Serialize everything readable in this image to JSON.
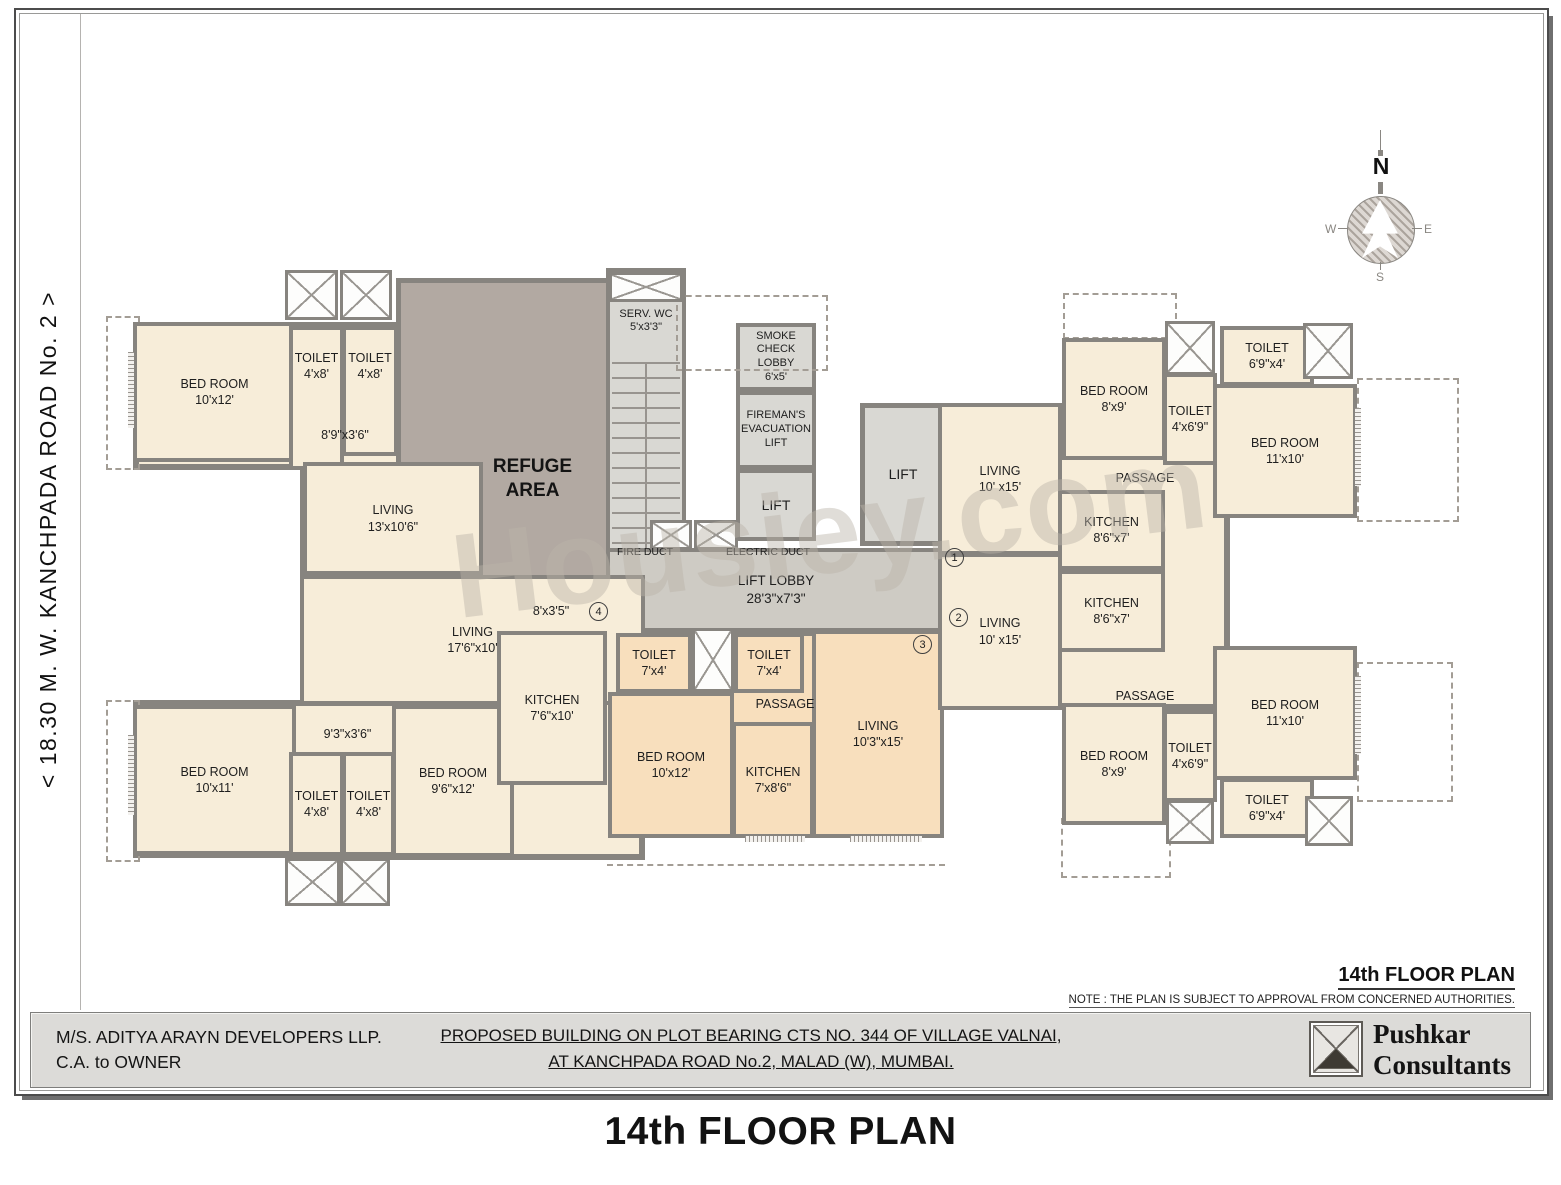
{
  "road_label": "<  18.30 M. W.  KANCHPADA ROAD No. 2  >",
  "watermark": "Housiey.com",
  "compass": {
    "n": "N",
    "e": "E",
    "s": "S",
    "w": "W"
  },
  "titles": {
    "plan_heading": "14th FLOOR PLAN",
    "note": "NOTE : THE PLAN IS SUBJECT TO APPROVAL FROM CONCERNED AUTHORITIES.",
    "main": "14th FLOOR PLAN"
  },
  "footer": {
    "developer_line1": "M/S. ADITYA ARAYN DEVELOPERS LLP.",
    "developer_line2": "C.A. to OWNER",
    "project_line1": "PROPOSED BUILDING ON PLOT BEARING CTS NO. 344 OF VILLAGE VALNAI,",
    "project_line2": "AT KANCHPADA ROAD No.2, MALAD (W), MUMBAI.",
    "consultant_line1": "Pushkar",
    "consultant_line2": "Consultants"
  },
  "labels": {
    "refuge_l1": "REFUGE",
    "refuge_l2": "AREA",
    "serv_l1": "SERV. WC",
    "serv_dims": "5'x3'3\"",
    "smoke_l1": "SMOKE",
    "smoke_l2": "CHECK",
    "smoke_l3": "LOBBY",
    "smoke_dims": "6'x5'",
    "fireman_l1": "FIREMAN'S",
    "fireman_l2": "EVACUATION",
    "fireman_l3": "LIFT",
    "lift": "LIFT",
    "lift_lobby": "LIFT LOBBY",
    "lift_lobby_dims": "28'3\"x7'3\"",
    "fire_duct": "FIRE DUCT",
    "electric_duct": "ELECTRIC DUCT",
    "passage": "PASSAGE",
    "passage_tl_dims": "8'9\"x3'6\"",
    "passage_bl_dims": "9'3\"x3'6\"",
    "passage_k_dims": "8'x3'5\""
  },
  "units": {
    "u1": "1",
    "u2": "2",
    "u3": "3",
    "u4": "4"
  },
  "rooms": {
    "bedroom_tl": {
      "name": "BED ROOM",
      "dims": "10'x12'"
    },
    "toilet_tl1": {
      "name": "TOILET",
      "dims": "4'x8'"
    },
    "toilet_tl2": {
      "name": "TOILET",
      "dims": "4'x8'"
    },
    "living_tl": {
      "name": "LIVING",
      "dims": "13'x10'6\""
    },
    "living_bl": {
      "name": "LIVING",
      "dims": "17'6\"x10'"
    },
    "bedroom_bl1": {
      "name": "BED ROOM",
      "dims": "10'x11'"
    },
    "toilet_bl1": {
      "name": "TOILET",
      "dims": "4'x8'"
    },
    "toilet_bl2": {
      "name": "TOILET",
      "dims": "4'x8'"
    },
    "bedroom_bl2": {
      "name": "BED ROOM",
      "dims": "9'6\"x12'"
    },
    "kitchen_bl": {
      "name": "KITCHEN",
      "dims": "7'6\"x10'"
    },
    "toilet_c1": {
      "name": "TOILET",
      "dims": "7'x4'"
    },
    "toilet_c2": {
      "name": "TOILET",
      "dims": "7'x4'"
    },
    "bedroom_c": {
      "name": "BED ROOM",
      "dims": "10'x12'"
    },
    "kitchen_c": {
      "name": "KITCHEN",
      "dims": "7'x8'6\""
    },
    "living_c": {
      "name": "LIVING",
      "dims": "10'3\"x15'"
    },
    "living_r1": {
      "name": "LIVING",
      "dims": "10' x15'"
    },
    "living_r2": {
      "name": "LIVING",
      "dims": "10' x15'"
    },
    "kitchen_r1": {
      "name": "KITCHEN",
      "dims": "8'6\"x7'"
    },
    "kitchen_r2": {
      "name": "KITCHEN",
      "dims": "8'6\"x7'"
    },
    "bedroom_r1": {
      "name": "BED ROOM",
      "dims": "8'x9'"
    },
    "toilet_r1": {
      "name": "TOILET",
      "dims": "4'x6'9\""
    },
    "toilet_r2": {
      "name": "TOILET",
      "dims": "6'9\"x4'"
    },
    "bedroom_r2": {
      "name": "BED ROOM",
      "dims": "11'x10'"
    },
    "bedroom_r3": {
      "name": "BED ROOM",
      "dims": "8'x9'"
    },
    "toilet_r3": {
      "name": "TOILET",
      "dims": "4'x6'9\""
    },
    "bedroom_r4": {
      "name": "BED ROOM",
      "dims": "11'x10'"
    },
    "toilet_r4": {
      "name": "TOILET",
      "dims": "6'9\"x4'"
    }
  }
}
